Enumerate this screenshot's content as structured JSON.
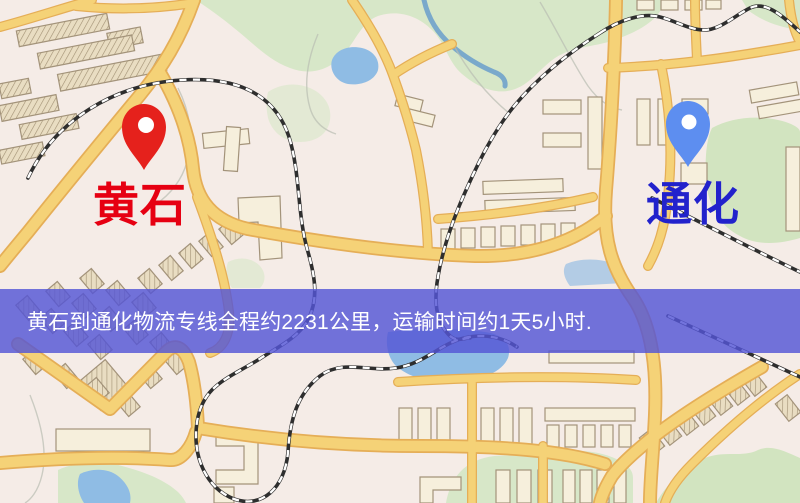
{
  "map": {
    "origin": {
      "name": "黄石",
      "marker": "red-pin"
    },
    "destination": {
      "name": "通化",
      "marker": "blue-pin"
    }
  },
  "banner": {
    "text": "黄石到通化物流专线全程约2231公里，运输时间约1天5小时.",
    "distance_km": "2231",
    "duration": "1天5小时"
  },
  "colors": {
    "map-bg": "#f5ece7",
    "road-fill": "#f5d277",
    "road-edge": "#e5ae57",
    "building-fill": "#f6efdc",
    "building-edge": "#a3937a",
    "building-hatch": "#e9ddc2",
    "rail-dark": "#2e2e2e",
    "green": "#d7e7c8",
    "green2": "#d2e4c0",
    "water": "#8fbce4",
    "river": "#6a9ecb",
    "origin-marker": "#e5211c",
    "dest-marker": "#5d8ef0",
    "origin-label": "#e60012",
    "dest-label": "#2222cc",
    "banner-bg": "rgba(84,86,214,0.82)",
    "banner-text": "#ffffff"
  }
}
